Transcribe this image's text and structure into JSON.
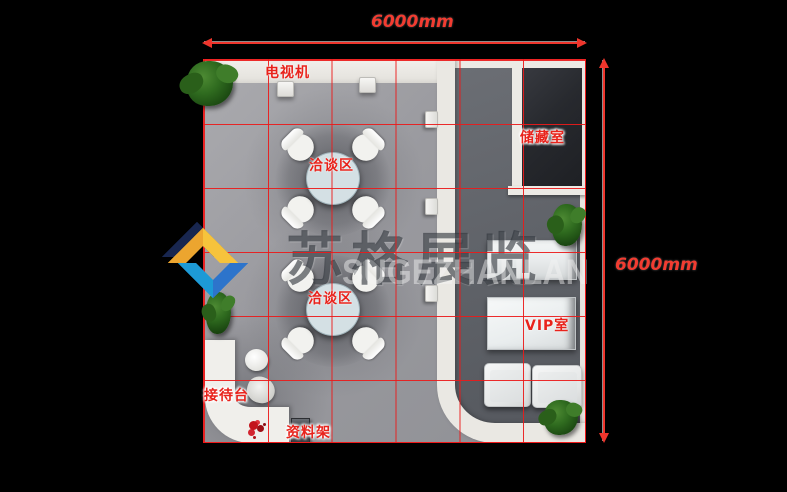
{
  "dimensions": {
    "top": "6000mm",
    "right": "6000mm"
  },
  "labels": {
    "tv": "电视机",
    "meeting_1": "洽谈区",
    "meeting_2": "洽谈区",
    "storage": "储藏室",
    "vip": "VIP室",
    "reception": "接待台",
    "rack": "资料架"
  },
  "watermark": {
    "cn": "苏格展览",
    "en": "SUGEZHANLAN"
  },
  "colors": {
    "background": "#000000",
    "grid_line": "#eb1a1a",
    "label_red": "#e8231c",
    "dimension_red": "#ef352c",
    "carpet_gray": "#9a9a9f",
    "vip_floor_gray": "#5e6167",
    "storage_dark": "#27292e",
    "wall_white": "#eae8e3",
    "logo_blue": "#2d74cb",
    "logo_gold": "#eca52f"
  }
}
